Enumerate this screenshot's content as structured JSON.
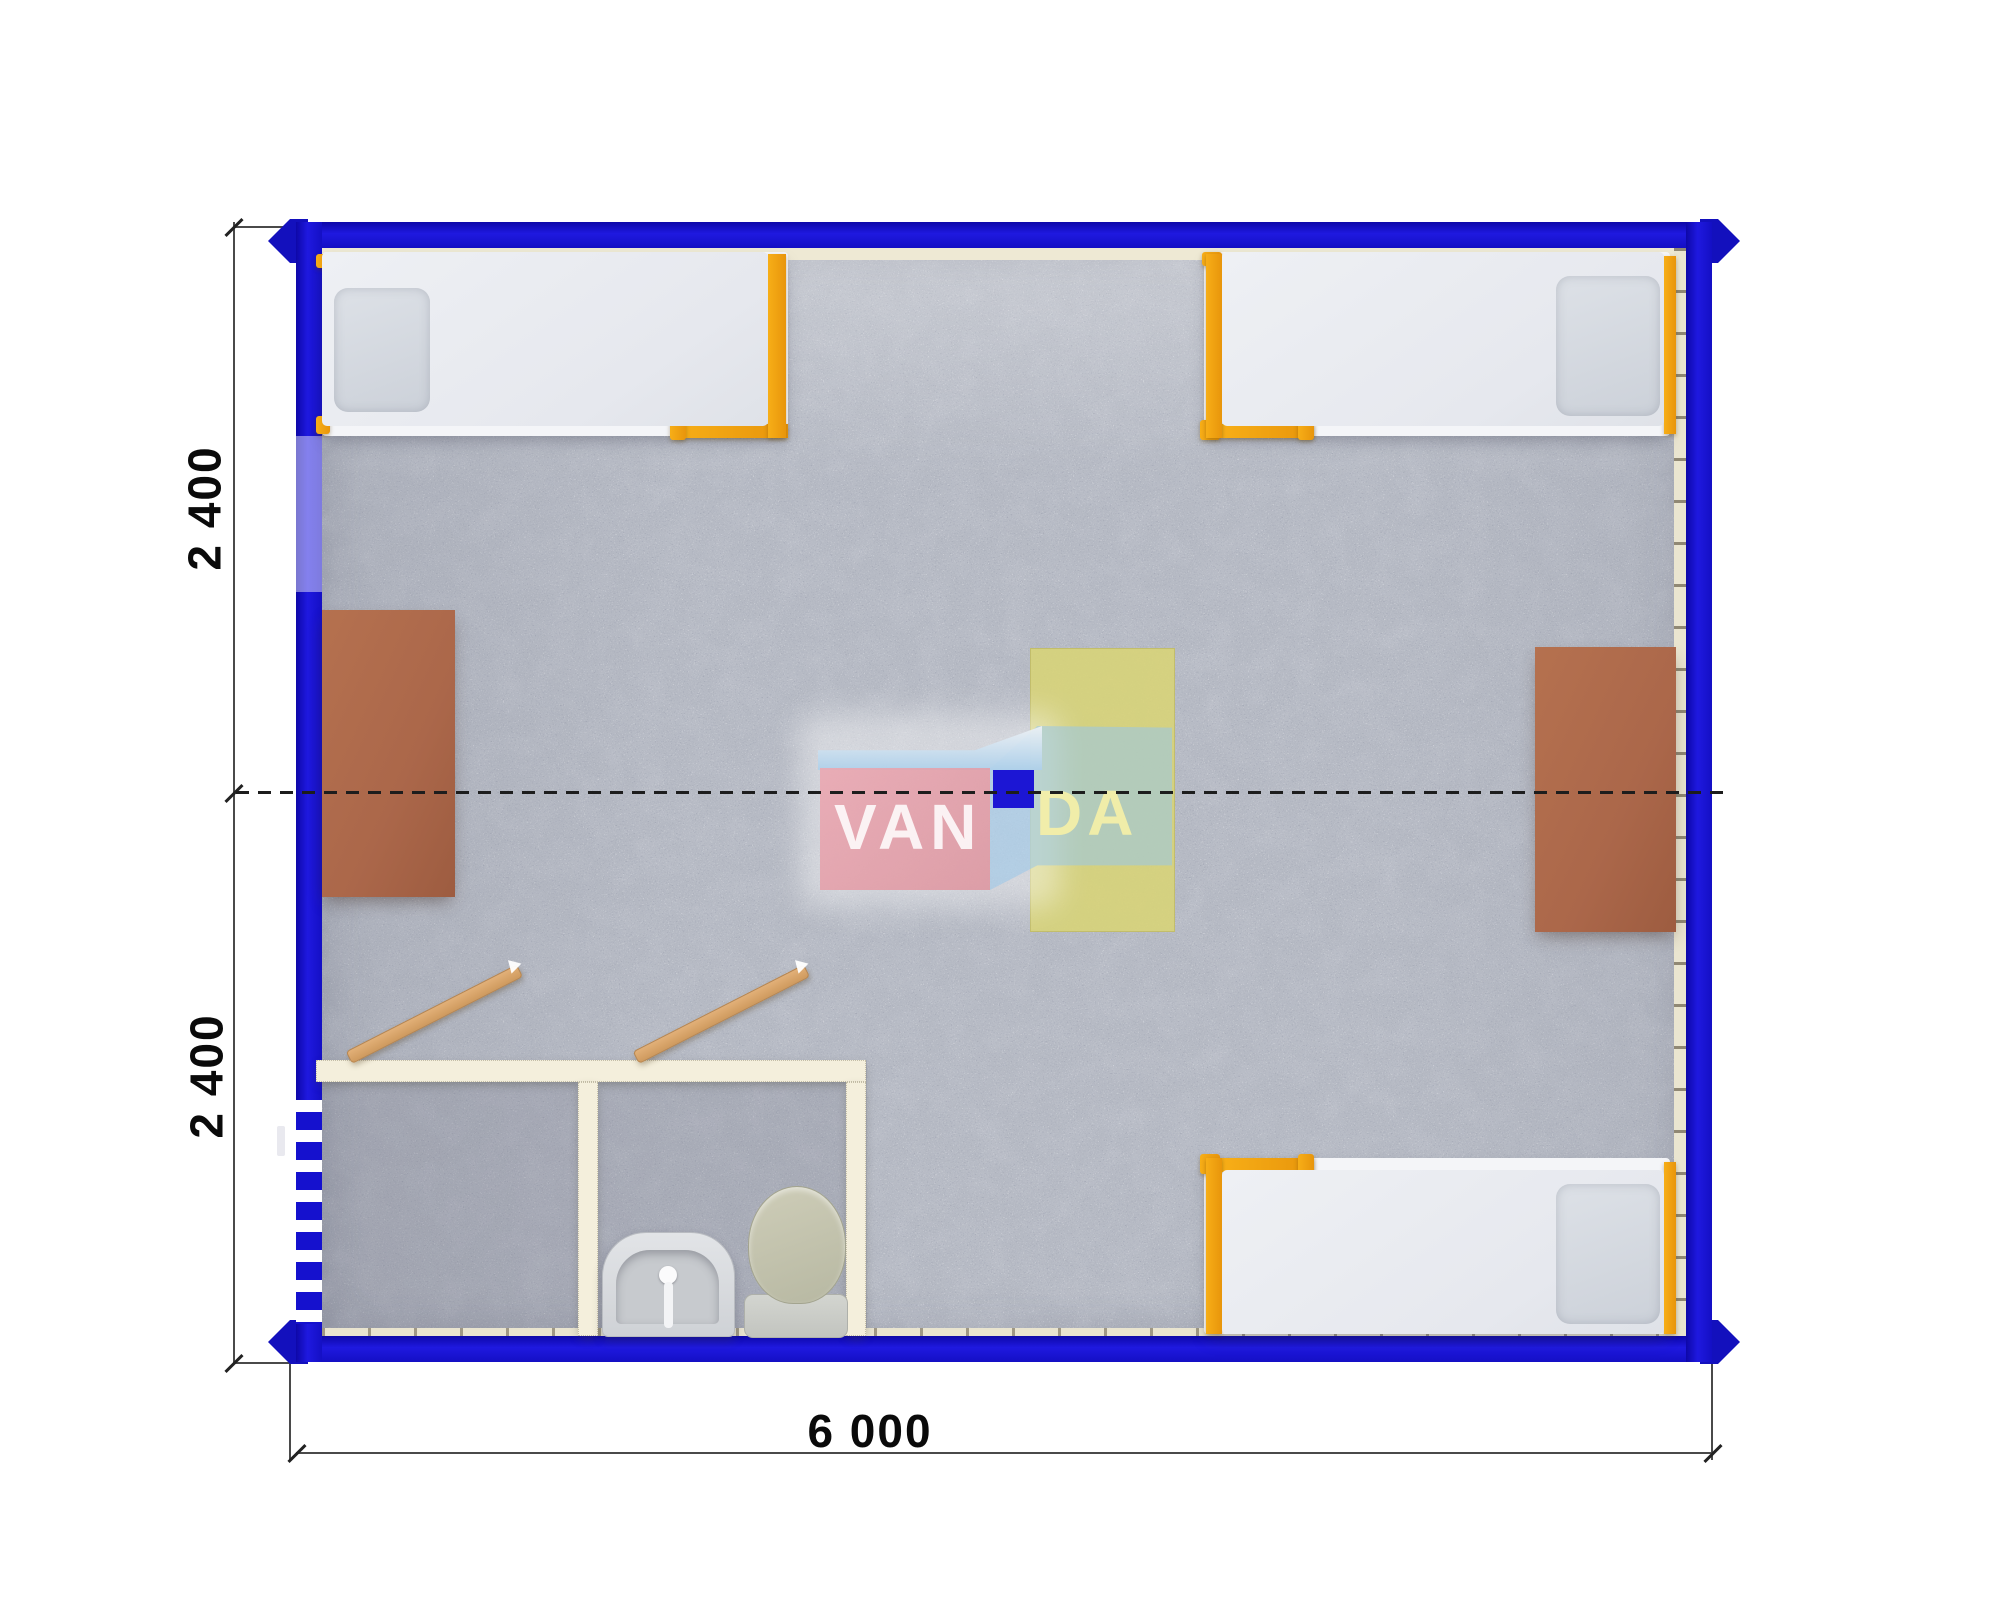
{
  "plan": {
    "type": "container-module-floor-plan",
    "view": "top-down"
  },
  "dimensions": {
    "side_upper": "2 400",
    "side_lower": "2 400",
    "bottom": "6 000",
    "units": "mm"
  },
  "watermark": {
    "left": "VAN",
    "right": "DA"
  },
  "rooms": {
    "main_room": {
      "furniture": [
        "single-bed-top-left",
        "single-bed-top-right",
        "single-bed-bottom-right",
        "desk-left-wall",
        "desk-right-wall",
        "table-center-yellow"
      ]
    },
    "bathroom": {
      "fixtures": [
        "wash-basin",
        "toilet"
      ],
      "doors": [
        "interior-door-left-room",
        "interior-door-sanitary-room"
      ]
    },
    "entrance": [
      "entrance-door-left-wall"
    ]
  },
  "colors": {
    "wall_blue": "#1511ce",
    "floor_gray": "#b6bac4",
    "partition_cream": "#f4efdc",
    "bed_frame_orange": "#f0a213",
    "desk_brown": "#ae6a4c",
    "table_yellow": "#d8d476",
    "logo_pink": "#e7a2ac",
    "logo_blue_square": "#1c16d4",
    "dashed_joint_line": "#1d1d1d"
  }
}
